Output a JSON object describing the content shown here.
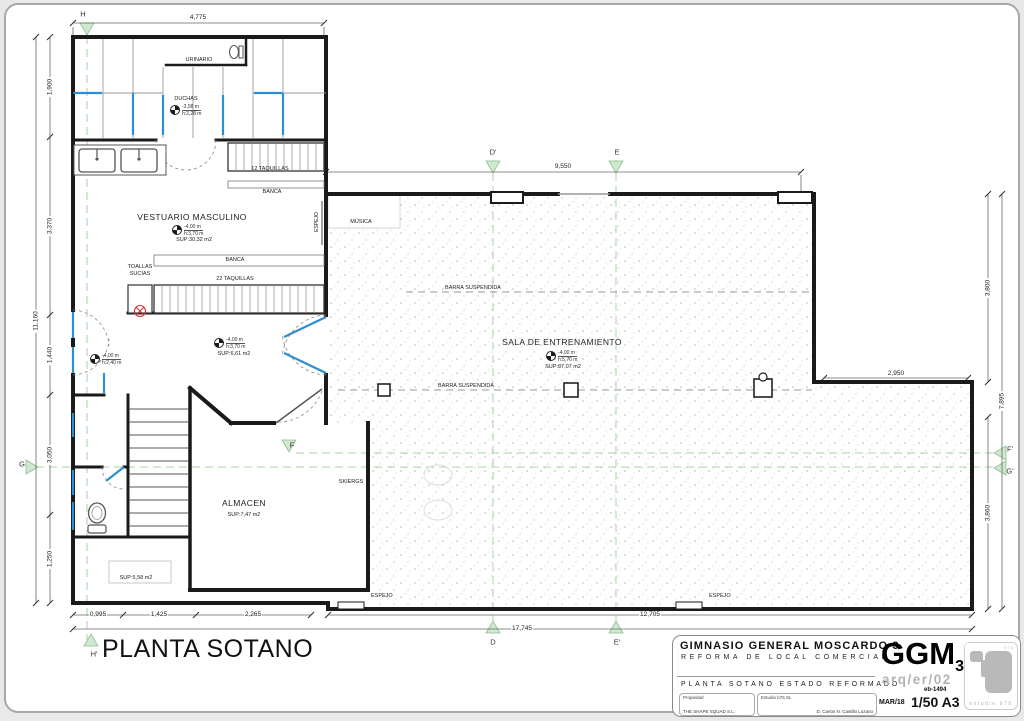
{
  "sheet": {
    "plan_title": "PLANTA SOTANO",
    "wall_color": "#1a1a1a",
    "accent_blue": "#2b8fd1",
    "section_green": "#a5d6a5",
    "logo_gray": "#b9b9b9"
  },
  "rooms": {
    "vestuario": {
      "name": "VESTUARIO MASCULINO",
      "level": "-4,00 m",
      "height": "h:3,70 m",
      "area": "SUP:30,32 m2"
    },
    "duchas": {
      "name": "DUCHAS",
      "level": "-3,98 m",
      "height": "h:2,28 m"
    },
    "urinario": {
      "name": "URINARIO"
    },
    "sala": {
      "name": "SALA DE ENTRENAMIENTO",
      "level": "-4,00 m",
      "height": "h:5,70 m",
      "area": "SUP:87,07 m2"
    },
    "almacen": {
      "name": "ALMACEN",
      "area": "SUP:7,47 m2"
    },
    "pasillo": {
      "level": "-4,00 m",
      "height": "h:3,70 m",
      "area": "SUP:6,61 m2"
    },
    "escalera": {
      "level": "-4,00 m",
      "height": "h:2,40 m"
    },
    "aseo": {
      "area": "SUP:5,58 m2"
    }
  },
  "fixtures": {
    "taquillas_top": "12 TAQUILLAS",
    "banca": "BANCA",
    "taquillas_bottom": "22 TAQUILLAS",
    "toallas_1": "TOALLAS",
    "toallas_2": "SUCIAS",
    "espejo": "ESPEJO",
    "musica": "MÚSICA",
    "skiergs": "SKIERGS",
    "barra": "BARRA SUSPENDIDA"
  },
  "dims": {
    "top": "4,775",
    "top_mid": "9,550",
    "left": [
      "1,900",
      "3,370",
      "1,440",
      "3,050",
      "1,250"
    ],
    "left_total": "11,160",
    "right": [
      "3,800",
      "3,860"
    ],
    "right_total": "7,895",
    "right_h": "2,950",
    "bottom": [
      "0,995",
      "1,425",
      "2,265",
      "12,705"
    ],
    "bottom_total": "17,745"
  },
  "markers": {
    "h": "H",
    "h2": "H'",
    "g": "G",
    "g2": "G'",
    "f": "F",
    "f2": "F'",
    "d": "D",
    "d2": "D'",
    "e": "E",
    "e2": "E'"
  },
  "titleblock": {
    "project": "GIMNASIO GENERAL MOSCARDO 3",
    "subtitle": "REFORMA DE LOCAL COMERCIAL",
    "sheet_name": "PLANTA SOTANO ESTADO REFORMADO",
    "owner_label": "Propiedad",
    "owner": "THE SHAPE SQUAD S.L.",
    "studio_label": "Estudio b76 SL",
    "architect": "D. Carlos N. Castillo Lozano",
    "logo_big": "GGM",
    "logo_sub": "3",
    "code": "arq/er/02",
    "ref": "eb-1494",
    "date": "MAR/18",
    "scale": "1/50 A3",
    "studio_logo_text": "estudio b76",
    "studio_logo_top": "b76"
  }
}
